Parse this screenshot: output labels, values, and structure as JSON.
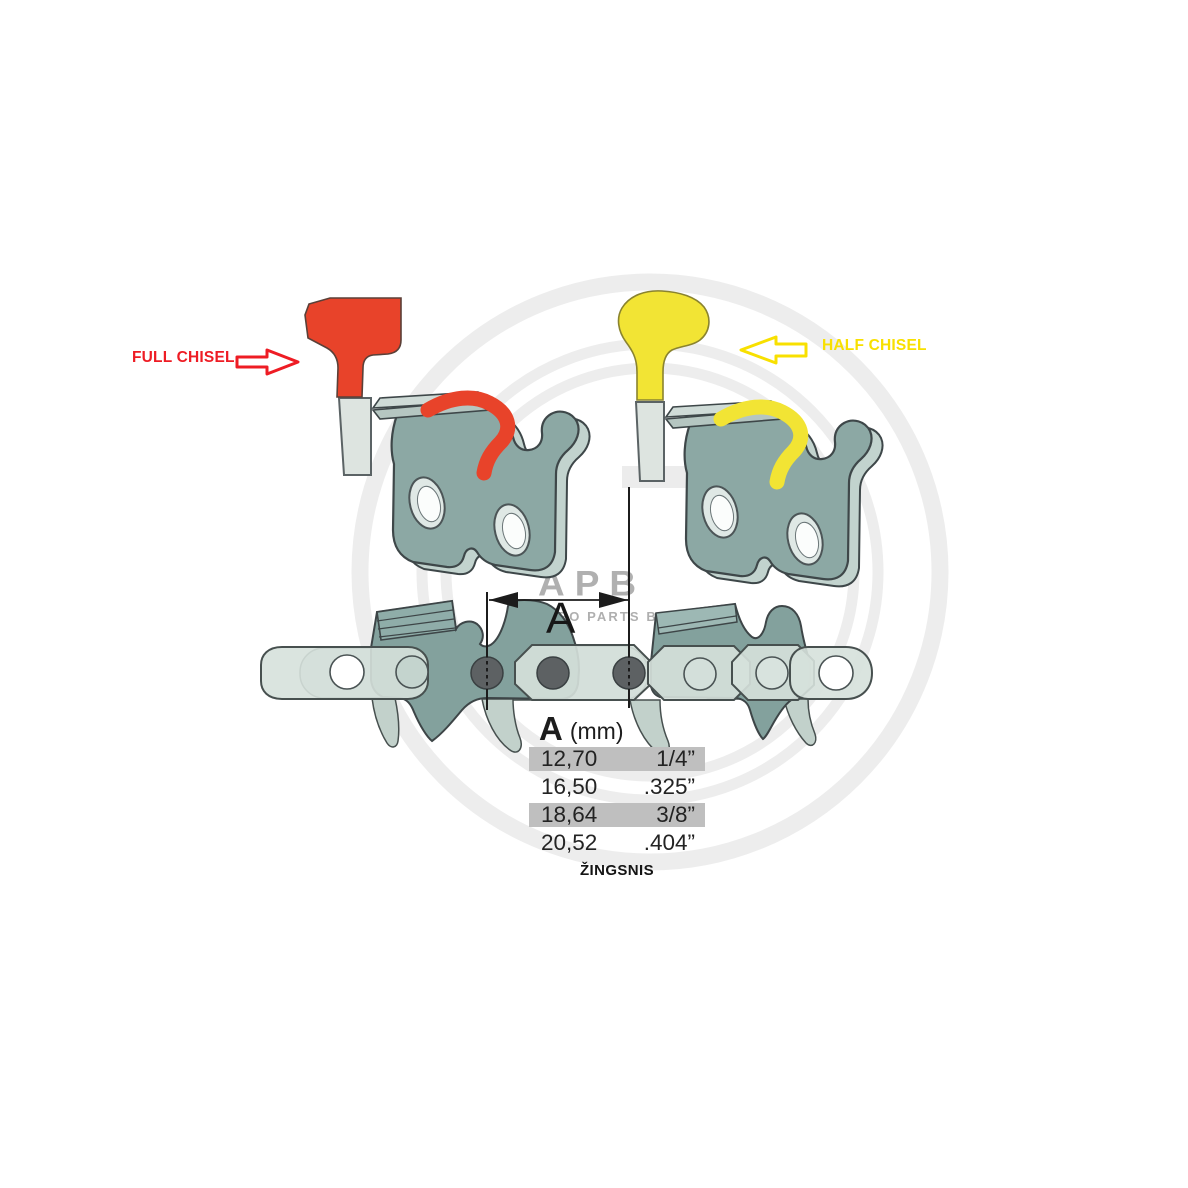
{
  "labels": {
    "full_chisel": "FULL CHISEL",
    "half_chisel": "HALF CHISEL",
    "dimension_label": "A",
    "pitch_caption": "ŽINGSNIS"
  },
  "watermark": {
    "logo": "APB",
    "subtitle": "AGRO PARTS BALTIJA"
  },
  "table": {
    "header_symbol": "A",
    "header_unit": "(mm)",
    "rows": [
      {
        "mm": "12,70",
        "inch": "1/4”",
        "highlighted": true
      },
      {
        "mm": "16,50",
        "inch": ".325”",
        "highlighted": false
      },
      {
        "mm": "18,64",
        "inch": "3/8”",
        "highlighted": true
      },
      {
        "mm": "20,52",
        "inch": ".404”",
        "highlighted": false
      }
    ]
  },
  "colors": {
    "full_chisel_red": "#e8432a",
    "half_chisel_yellow": "#f2e434",
    "label_red": "#ee1c24",
    "label_yellow": "#f8e000",
    "cutter_teal": "#8aa7a3",
    "chain_light": "#d6e1dc",
    "rivet_gray": "#5d6163",
    "row_highlight_gray": "#bfbfbf",
    "watermark_gray": "#ededed"
  }
}
